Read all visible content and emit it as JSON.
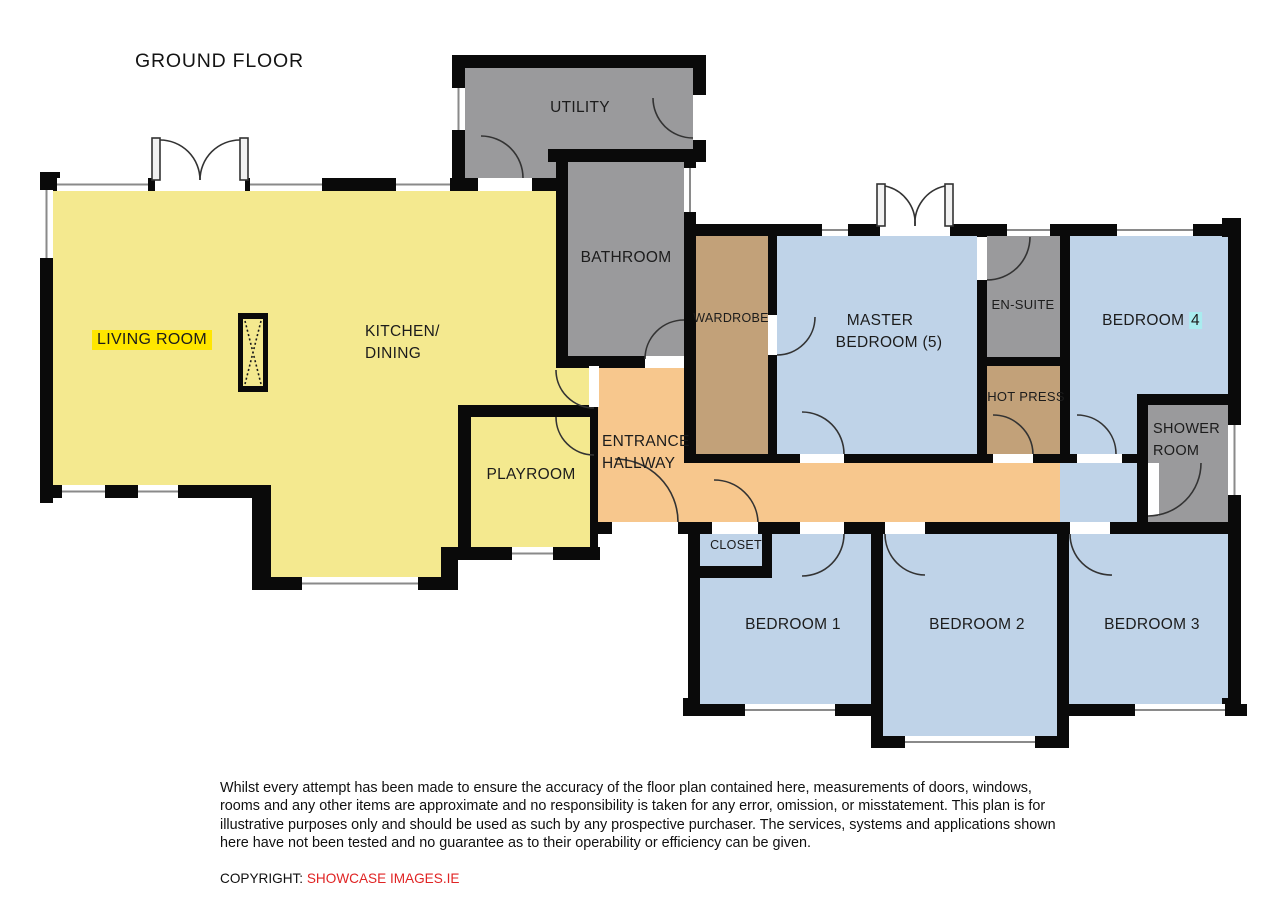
{
  "title": "GROUND FLOOR",
  "colors": {
    "room_yellow": "#f4e98f",
    "room_blue": "#bfd3e8",
    "room_gray": "#9a9a9c",
    "room_tan": "#c2a179",
    "room_orange": "#f7c78d",
    "wall_black": "#0a0a0a",
    "label_highlight_yellow": "#ffe600",
    "label_highlight_cyan": "#a9ecef",
    "copyright_red": "#e02424"
  },
  "rooms": {
    "utility": {
      "label": "UTILITY"
    },
    "bathroom": {
      "label": "BATHROOM"
    },
    "living": {
      "label": "LIVING ROOM"
    },
    "kitchen": {
      "line1": "KITCHEN/",
      "line2": "DINING"
    },
    "playroom": {
      "label": "PLAYROOM"
    },
    "hallway": {
      "line1": "ENTRANCE",
      "line2": "HALLWAY"
    },
    "wardrobe": {
      "label": "WARDROBE"
    },
    "master": {
      "line1": "MASTER",
      "line2": "BEDROOM (5)"
    },
    "ensuite": {
      "label": "EN-SUITE"
    },
    "hotpress": {
      "label": "HOT PRESS"
    },
    "bedroom4": {
      "prefix": "BEDROOM ",
      "number": "4"
    },
    "shower": {
      "line1": "SHOWER",
      "line2": "ROOM"
    },
    "closet": {
      "label": "CLOSET"
    },
    "bedroom1": {
      "label": "BEDROOM 1"
    },
    "bedroom2": {
      "label": "BEDROOM 2"
    },
    "bedroom3": {
      "label": "BEDROOM 3"
    }
  },
  "disclaimer": {
    "lines": [
      "Whilst every attempt has been made to ensure the accuracy of the floor plan contained here, measurements of doors, windows,",
      "rooms and any other items are approximate and no responsibility is taken for any error, omission, or misstatement.  This plan is for",
      "illustrative purposes only and should be used as such by any prospective purchaser.  The services, systems and applications shown",
      "here have not been tested and no guarantee as to their operability or efficiency can be given."
    ]
  },
  "copyright": {
    "prefix": "COPYRIGHT: ",
    "company": "SHOWCASE IMAGES.IE"
  }
}
